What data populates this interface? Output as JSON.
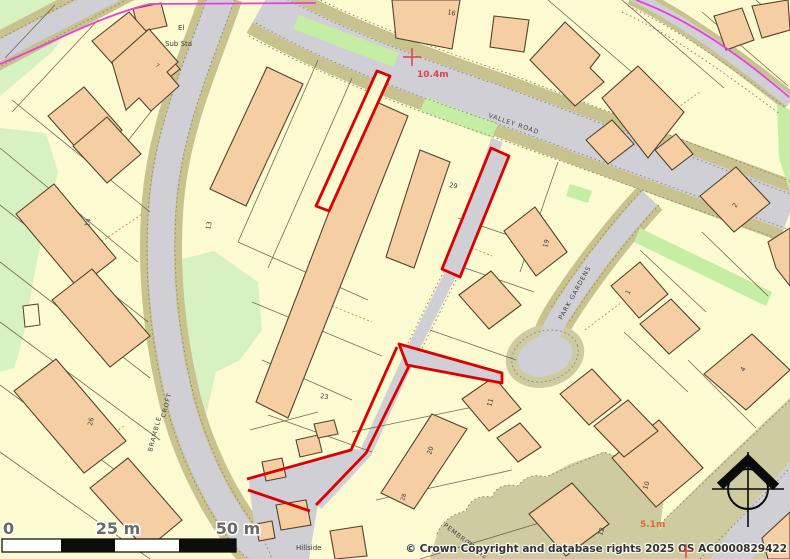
{
  "map_labels": {
    "el": "El",
    "sub_sta": "Sub Sta",
    "valley_road": "VALLEY ROAD",
    "park_gardens": "PARK GARDENS",
    "bramble": "BRAMBLE",
    "croft": "CROFT",
    "pembroke": "PEMBROKE",
    "close": "CLOSE",
    "hillside": "Hillside",
    "spot_height_a": "10.4m",
    "spot_height_b": "5.1m"
  },
  "house_numbers": {
    "n16": "16",
    "n7": "7",
    "n29": "29",
    "n19": "19",
    "n13": "13",
    "n14": "14",
    "n26": "26",
    "n23": "23",
    "n20": "20",
    "n28": "28",
    "n11": "11",
    "n1": "1",
    "n2": "2",
    "n4": "4",
    "n10": "10",
    "n12": "12"
  },
  "scale_bar": {
    "zero": "0",
    "mid": "25 m",
    "end": "50 m"
  },
  "copyright": "© Crown Copyright and database rights 2025 OS AC0000829422",
  "colors": {
    "background": "#FCFAD0",
    "building": "#F5CFA3",
    "building_outline": "#55422C",
    "road_gray": "#D0CFD6",
    "verge_olive": "#C8C28F",
    "olive_area": "#CFCBA0",
    "green_light": "#D8F1C0",
    "green_strip": "#C5EDA4",
    "boundary_magenta": "#E840D8",
    "site_red": "#DC0000",
    "red_text": "#E04343",
    "orange_text": "#DD6B28",
    "plot_line": "#5A5242",
    "dashed_orange": "#D08A4E",
    "road_edge_dot": "#8A8A70",
    "scale_text": "#6A6A6A",
    "copyright_text": "#333333"
  }
}
